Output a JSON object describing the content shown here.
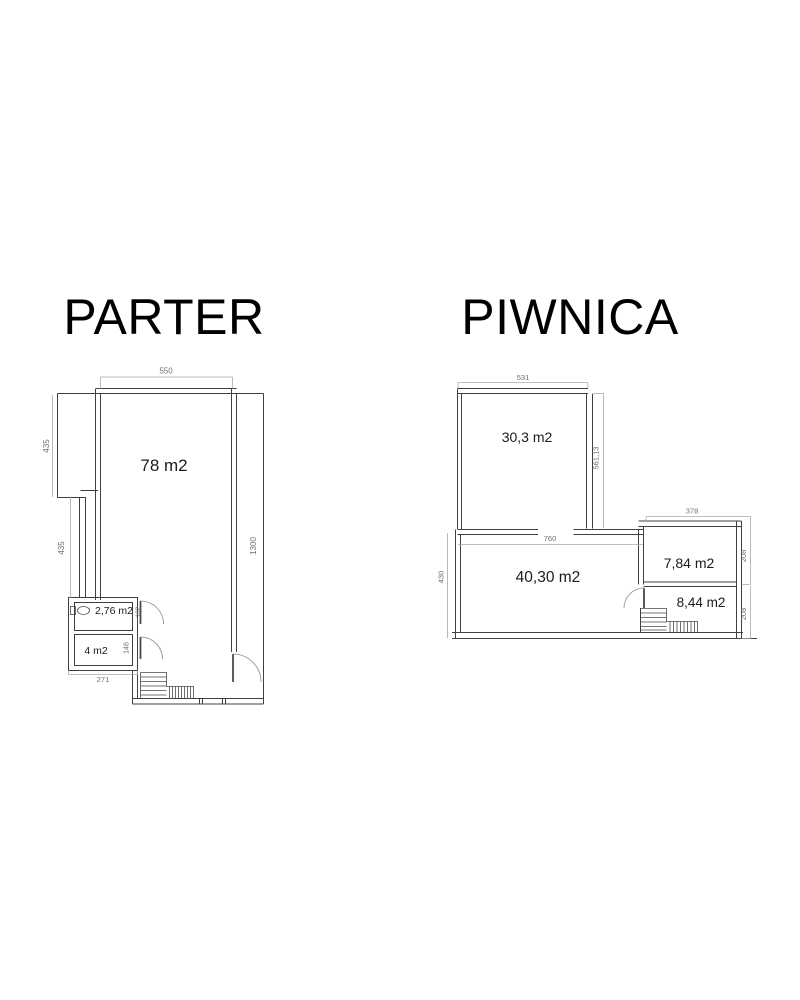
{
  "palette": {
    "background": "#ffffff",
    "wall_line": "#3f3f3f",
    "dimension_line": "#a8a8a8",
    "dimension_text": "#6f6f6f",
    "label_text": "#1b1b1b",
    "title_text": "#000000"
  },
  "plans": {
    "parter": {
      "title": "PARTER",
      "rooms": {
        "main": {
          "label": "78 m2"
        },
        "wc": {
          "label": "2,76 m2"
        },
        "storage": {
          "label": "4 m2"
        }
      },
      "dims": {
        "top_width": "550",
        "left_upper": "435",
        "left_lower": "435",
        "right_height": "1300",
        "wc_height": "102",
        "storage_height": "146",
        "bottom_width": "271"
      }
    },
    "piwnica": {
      "title": "PIWNICA",
      "rooms": {
        "upper": {
          "label": "30,3 m2"
        },
        "main": {
          "label": "40,30 m2"
        },
        "side_upper": {
          "label": "7,84 m2"
        },
        "side_lower": {
          "label": "8,44 m2"
        }
      },
      "dims": {
        "top_width": "531",
        "upper_right_height": "561,13",
        "middle_width": "760",
        "left_height": "430",
        "side_top_width": "378",
        "side_right_upper": "208",
        "side_right_lower": "208"
      }
    }
  }
}
